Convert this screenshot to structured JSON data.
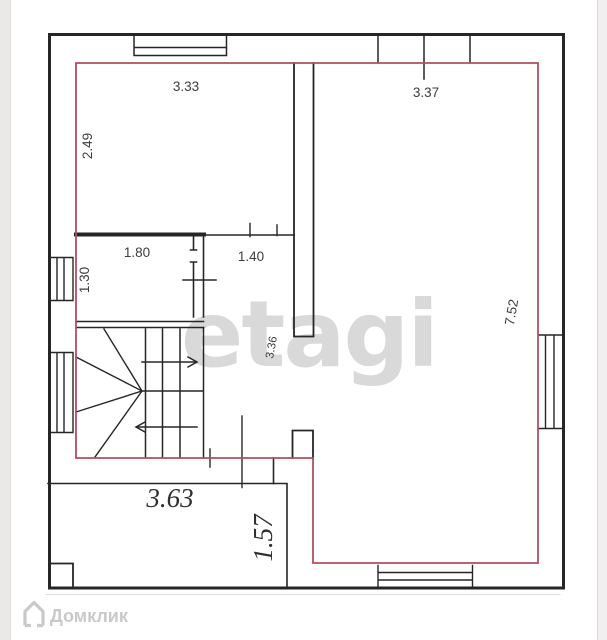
{
  "watermarks": {
    "brand_center": "etagi",
    "brand_bottom": "Домклик",
    "logo_icon": "house-icon"
  },
  "colors": {
    "outline_red": "#b04f5c",
    "wall_black": "#262626",
    "dimension_text": "#3d3d3d",
    "watermark_gray": "#d9d9d9",
    "watermark_logo_gray": "#c9c9c9",
    "page_edge_gray": "#ebe8e8"
  },
  "dimensions": {
    "room_top_left_width": "3.33",
    "room_top_left_height": "2.49",
    "room_right_width": "3.37",
    "room_right_height": "7.52",
    "room_small_width": "1.80",
    "room_small_height": "1.30",
    "hall_width": "1.40",
    "hall_height": "3.36",
    "room_bottom_left_width": "3.63",
    "room_bottom_left_height": "1.57"
  }
}
